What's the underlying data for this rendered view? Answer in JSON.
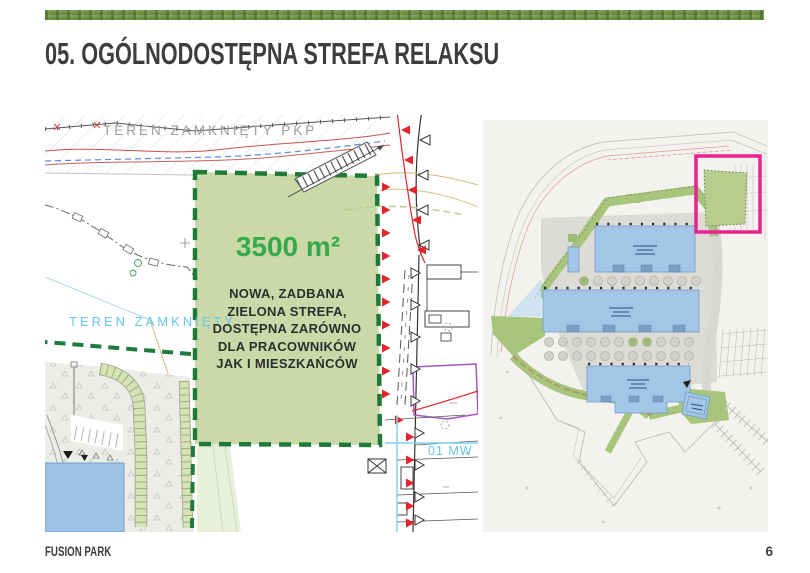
{
  "header": {
    "title": "05. OGÓLNODOSTĘPNA STREFA RELAKSU"
  },
  "detail_map": {
    "area_label": "3500 m²",
    "description": "NOWA, ZADBANA\nZIELONA STREFA,\nDOSTĘPNA ZARÓWNO\nDLA PRACOWNIKÓW\nJAK I MIESZKAŃCÓW",
    "label_pkp": "TEREN ZAMKNIĘTY PKP",
    "label_closed": "TEREN ZAMKNIĘTY",
    "label_zone": "01 MW"
  },
  "footer": {
    "project": "FUSION PARK",
    "page": "6"
  },
  "colors": {
    "accent_bar_green": "#6B8E42",
    "zone_border_green": "#1D7A39",
    "zone_fill_green": "#CBD9A8",
    "area_text_green": "#35A94C",
    "map_label_cyan": "#66C6E9",
    "map_label_gray": "#9C9C9C",
    "highlight_magenta": "#EC2190",
    "building_blue": "#9CC2E5",
    "plan_green": "#A7C47B",
    "slope_marker_red": "#E3242B",
    "title_text": "#3D3D3D",
    "page_background": "#FFFFFF"
  }
}
